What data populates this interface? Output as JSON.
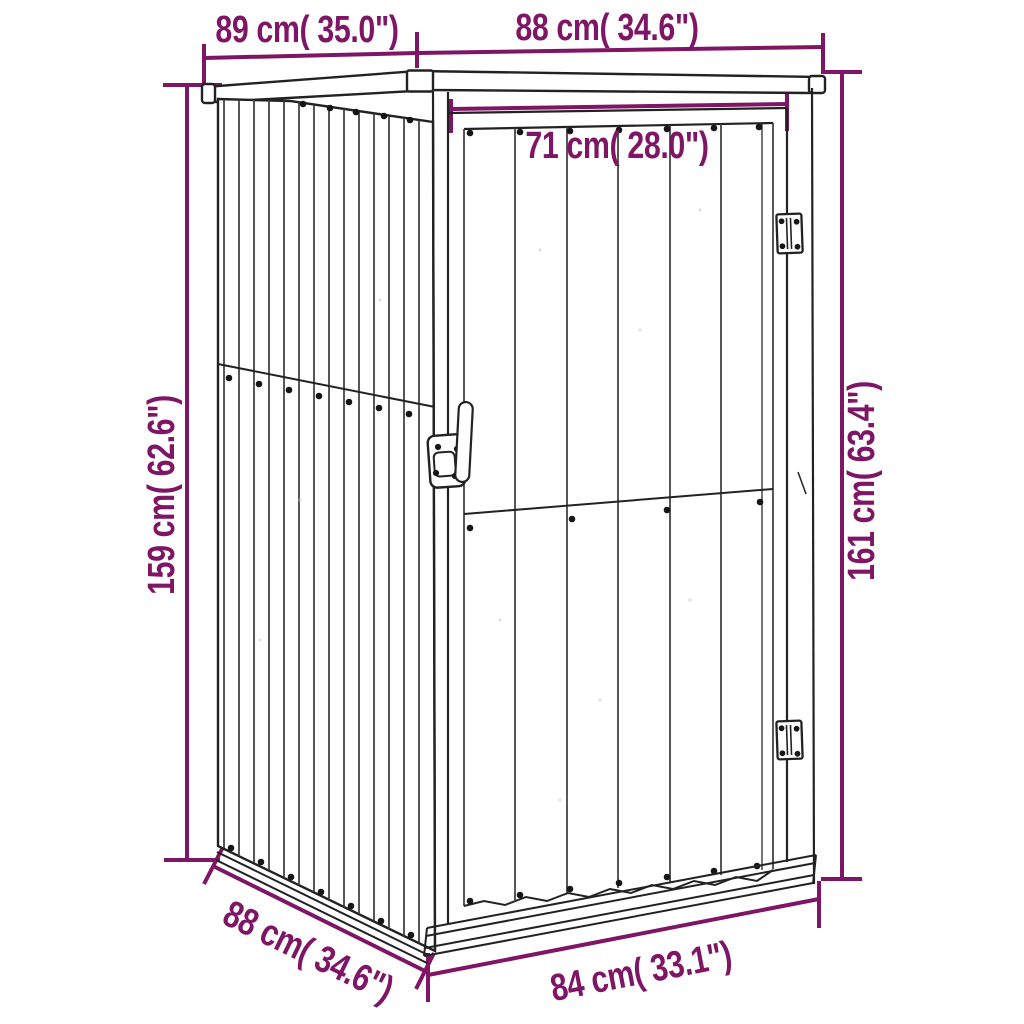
{
  "figure": {
    "kind": "product-dimension-diagram",
    "colors": {
      "dimension_annotation": "#7E1565",
      "line_art": "#222222",
      "background": "#FFFFFF"
    },
    "dimensions": [
      {
        "id": "roof-side-depth",
        "label": "89 cm( 35.0\")"
      },
      {
        "id": "roof-front-width",
        "label": "88 cm( 34.6\")"
      },
      {
        "id": "door-width",
        "label": "71 cm( 28.0\")"
      },
      {
        "id": "height-left",
        "label": "159 cm( 62.6\")"
      },
      {
        "id": "height-right",
        "label": "161 cm( 63.4\")"
      },
      {
        "id": "base-side-depth",
        "label": "88 cm( 34.6\")"
      },
      {
        "id": "base-front-width",
        "label": "84 cm( 33.1\")"
      }
    ]
  }
}
